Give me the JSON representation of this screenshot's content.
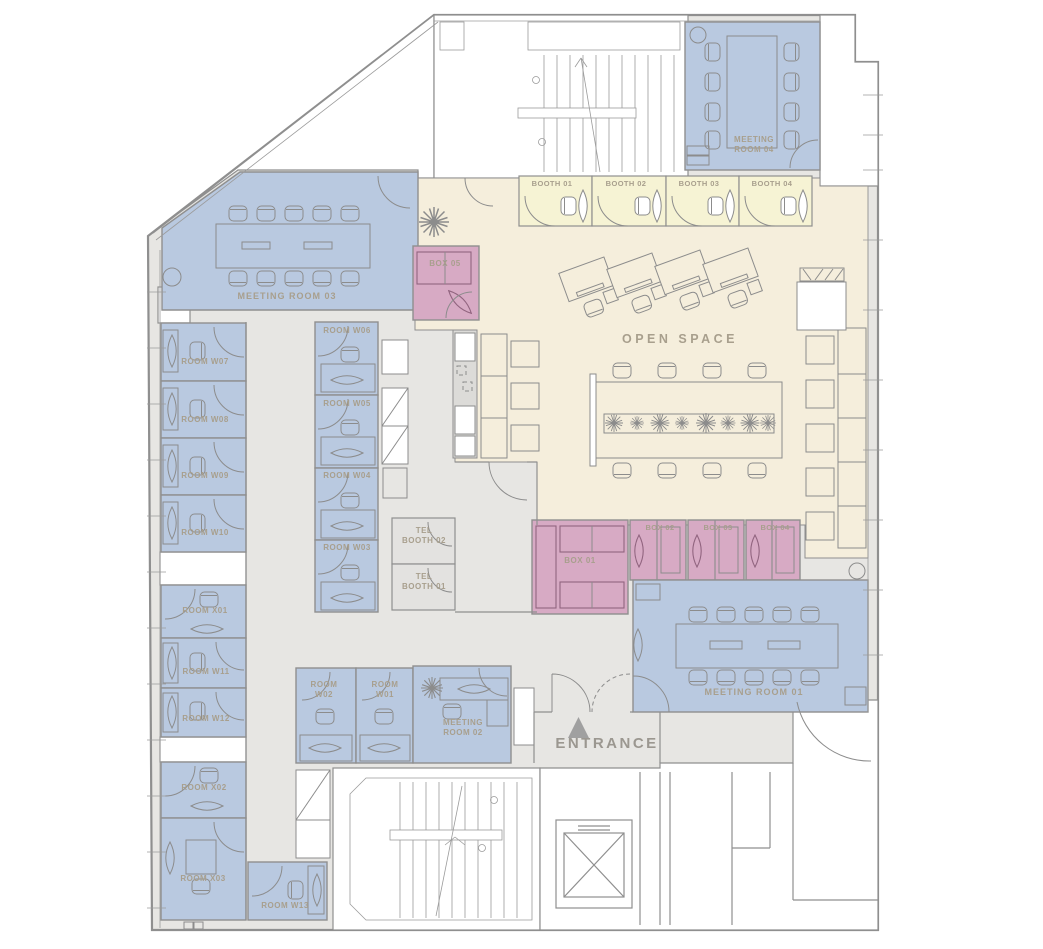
{
  "colors": {
    "meeting": "#b9c9e0",
    "box": "#d7aac4",
    "cream": "#f5eedc",
    "booth": "#f6f3d4",
    "corridor": "#e7e6e3",
    "kitchen": "#dcdbd8",
    "telbooth": "#e3e2e0",
    "wall": "#8f8f8f",
    "label": "#a89f8d",
    "entrance_text": "#9b9790",
    "triangle": "#a0a0a0"
  },
  "rooms": [
    {
      "id": "meeting-room-03",
      "label": "MEETING ROOM 03"
    },
    {
      "id": "room-w07",
      "label": "ROOM W07"
    },
    {
      "id": "room-w08",
      "label": "ROOM W08"
    },
    {
      "id": "room-w09",
      "label": "ROOM W09"
    },
    {
      "id": "room-w10",
      "label": "ROOM W10"
    },
    {
      "id": "room-x01",
      "label": "ROOM X01"
    },
    {
      "id": "room-w11",
      "label": "ROOM W11"
    },
    {
      "id": "room-w12",
      "label": "ROOM W12"
    },
    {
      "id": "room-x02",
      "label": "ROOM X02"
    },
    {
      "id": "room-x03",
      "label": "ROOM X03"
    },
    {
      "id": "room-w13",
      "label": "ROOM W13"
    },
    {
      "id": "room-w06",
      "label": "ROOM W06"
    },
    {
      "id": "room-w05",
      "label": "ROOM W05"
    },
    {
      "id": "room-w04",
      "label": "ROOM W04"
    },
    {
      "id": "room-w03",
      "label": "ROOM W03"
    },
    {
      "id": "room-w02",
      "label": "ROOM\nW02"
    },
    {
      "id": "room-w01",
      "label": "ROOM\nW01"
    },
    {
      "id": "meeting-room-02",
      "label": "MEETING\nROOM 02"
    },
    {
      "id": "tel-booth-02",
      "label": "TEL\nBOOTH 02"
    },
    {
      "id": "tel-booth-01",
      "label": "TEL\nBOOTH 01"
    },
    {
      "id": "box-05",
      "label": "BOX 05"
    },
    {
      "id": "box-01",
      "label": "BOX 01"
    },
    {
      "id": "box-02",
      "label": "BOX 02"
    },
    {
      "id": "box-03",
      "label": "BOX 03"
    },
    {
      "id": "box-04",
      "label": "BOX 04"
    },
    {
      "id": "booth-01",
      "label": "BOOTH 01"
    },
    {
      "id": "booth-02",
      "label": "BOOTH 02"
    },
    {
      "id": "booth-03",
      "label": "BOOTH 03"
    },
    {
      "id": "booth-04",
      "label": "BOOTH 04"
    },
    {
      "id": "open-space",
      "label": "OPEN SPACE"
    },
    {
      "id": "meeting-room-04",
      "label": "MEETING\nROOM 04"
    },
    {
      "id": "meeting-room-01",
      "label": "MEETING ROOM 01"
    },
    {
      "id": "entrance",
      "label": "ENTRANCE"
    }
  ]
}
